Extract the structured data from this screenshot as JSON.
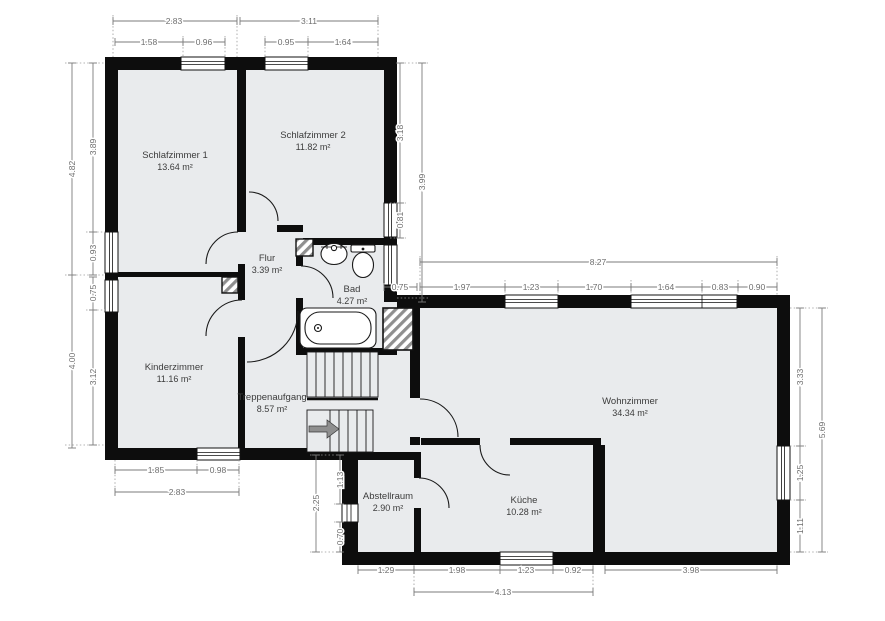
{
  "rooms": {
    "schlafzimmer1": {
      "name": "Schlafzimmer 1",
      "area": "13.64 m²"
    },
    "schlafzimmer2": {
      "name": "Schlafzimmer 2",
      "area": "11.82 m²"
    },
    "flur": {
      "name": "Flur",
      "area": "3.39 m²"
    },
    "bad": {
      "name": "Bad",
      "area": "4.27 m²"
    },
    "kinderzimmer": {
      "name": "Kinderzimmer",
      "area": "11.16 m²"
    },
    "treppenaufgang": {
      "name": "Treppenaufgang",
      "area": "8.57 m²"
    },
    "wohnzimmer": {
      "name": "Wohnzimmer",
      "area": "34.34 m²"
    },
    "abstellraum": {
      "name": "Abstellraum",
      "area": "2.90 m²"
    },
    "kueche": {
      "name": "Küche",
      "area": "10.28 m²"
    }
  },
  "dims": {
    "top_s1_total": "2.83",
    "top_s2_total": "3.11",
    "top_s1_a": "1.58",
    "top_s1_win": "0.96",
    "top_s2_win": "0.95",
    "top_s2_b": "1.64",
    "left_total_upper": "4.82",
    "left_s1": "3.89",
    "left_s1_win": "0.93",
    "left_kz_win": "0.75",
    "left_kz": "3.12",
    "left_total_lower": "4.00",
    "right_s2": "3.18",
    "right_s2_win": "0.81",
    "right_total": "3.99",
    "mid_gap": "0.75",
    "wz_top_total": "8.27",
    "wz_top_a": "1.97",
    "wz_top_win1": "1.23",
    "wz_top_b": "1.70",
    "wz_top_win2": "1.64",
    "wz_top_win3": "0.83",
    "wz_top_c": "0.90",
    "wz_right_a": "3.33",
    "wz_right_win": "1.25",
    "wz_right_b": "1.11",
    "wz_right_total": "5.69",
    "kz_bottom_a": "1.85",
    "kz_bottom_win": "0.98",
    "kz_bottom_total": "2.83",
    "ab_left_a": "1.13",
    "ab_left_b": "0.70",
    "ab_left_total": "2.25",
    "ab_bottom": "1.29",
    "ku_bottom_a": "1.98",
    "ku_bottom_win": "1.23",
    "ku_bottom_b": "0.92",
    "ku_bottom_total": "4.13",
    "wz_bottom": "3.98"
  },
  "colors": {
    "floor": "#e9ebed",
    "wall": "#0d0d0d",
    "dimension": "#7b7b7b",
    "room_text": "#3c3c3c"
  }
}
